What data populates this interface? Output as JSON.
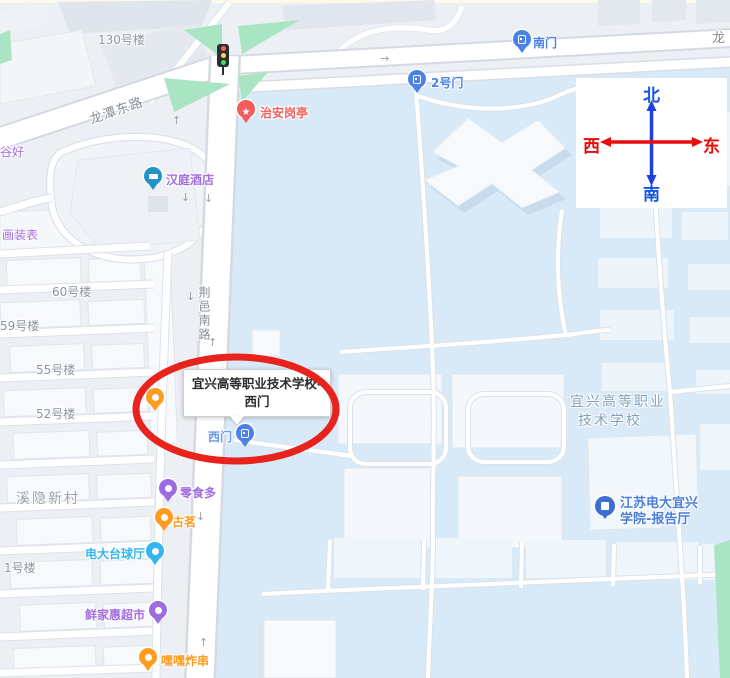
{
  "compass": {
    "north": "北",
    "south": "南",
    "west": "西",
    "east": "东"
  },
  "roads": {
    "longtan_east": "龙潭东路",
    "longtan_partial": "龙",
    "jingyi_south": "荆邑南路"
  },
  "campus": {
    "name_line1": "宜兴高等职业",
    "name_line2": "技术学校"
  },
  "neighborhood": {
    "village": "溪隐新村",
    "b130": "130号楼",
    "b60": "60号楼",
    "b59": "59号楼",
    "b55": "55号楼",
    "b52": "52号楼",
    "b1": "1号楼",
    "partial_top": "谷好",
    "partial_mid": "画装表"
  },
  "gates": {
    "south": "南门",
    "gate2": "2号门",
    "west": "西门"
  },
  "pois": {
    "security": "治安岗亭",
    "hotel": "汉庭酒店",
    "snack": "零食多",
    "tea": "古茗",
    "billiards": "电大台球厅",
    "market": "鲜家惠超市",
    "skewers": "嘿嘿炸串",
    "hall_line1": "江苏电大宜兴",
    "hall_line2": "学院-报告厅"
  },
  "callout": {
    "line1": "宜兴高等职业技术学校-",
    "line2": "西门"
  },
  "colors": {
    "campus_fill": "#d8eaf7",
    "outside_fill": "#eceff3",
    "green": "#a9e5c2",
    "highlight_stroke": "#e8231d",
    "gate_pin": "#4b82e8",
    "poi_purple": "#9d6ce0",
    "poi_orange": "#ff9b1e",
    "poi_cyan": "#35b5ef",
    "poi_red": "#f25c5c",
    "hotel_teal": "#2492c8",
    "hall_pin": "#3e6ed0",
    "compass_blue": "#1553ea",
    "compass_red": "#ea0b0b"
  }
}
